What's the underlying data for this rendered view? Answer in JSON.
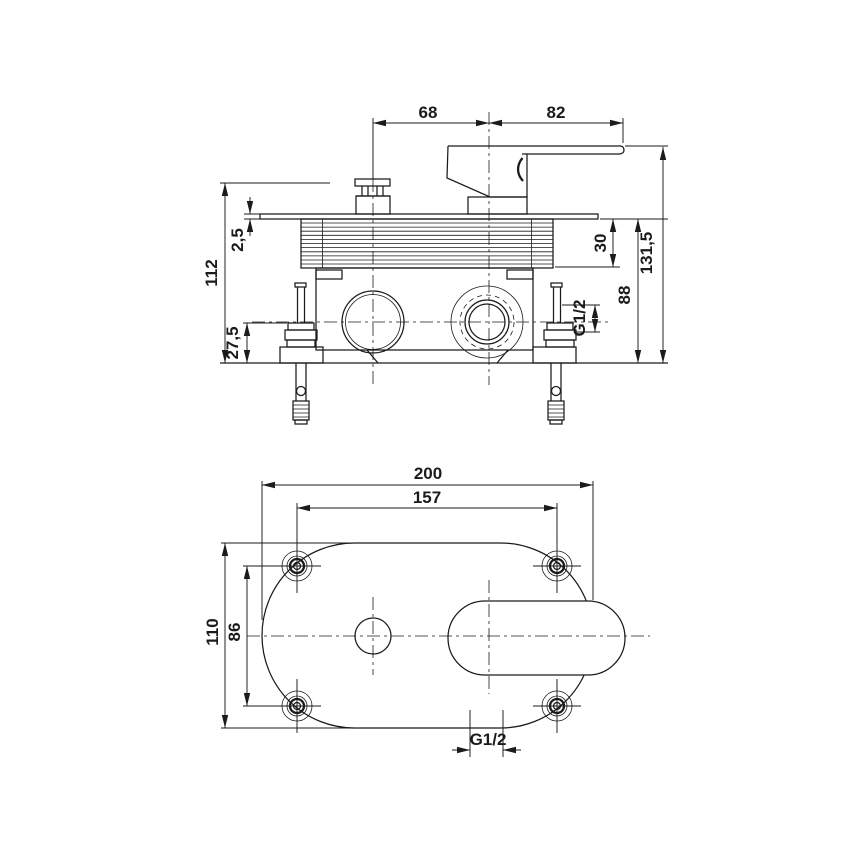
{
  "drawing": {
    "type": "technical-drawing",
    "subject": "concealed-mixer-valve",
    "units_style": "decimal-comma",
    "colors": {
      "line": "#1b1b1b",
      "background": "#ffffff"
    }
  },
  "side_view": {
    "dims": {
      "cap_to_center": "68",
      "center_to_lever_end": "82",
      "body_height": "112",
      "plate_thickness": "2,5",
      "bracket_height": "27,5",
      "sleeve_depth": "30",
      "plate_to_wall": "88",
      "total_height": "131,5",
      "thread_size": "G1/2"
    }
  },
  "plan_view": {
    "dims": {
      "total_width": "200",
      "screw_spacing_horizontal": "157",
      "total_depth": "110",
      "screw_spacing_vertical": "86",
      "outlet_thread": "G1/2"
    }
  }
}
